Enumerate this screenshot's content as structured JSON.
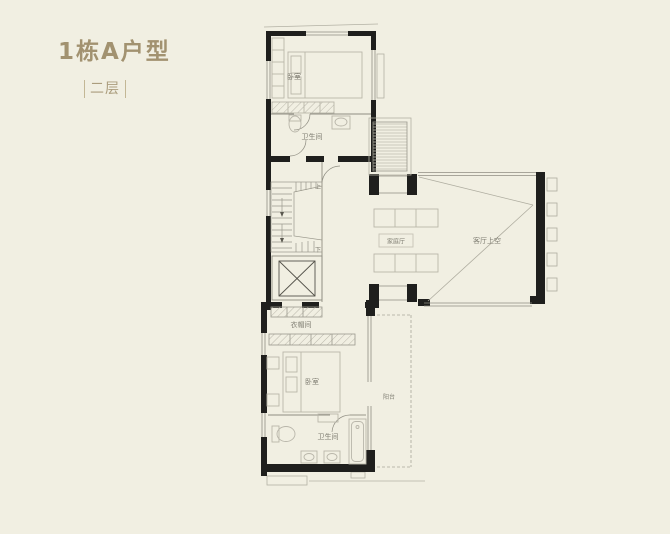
{
  "page": {
    "title": "1栋A户型",
    "subtitle": "二层",
    "colors": {
      "background": "#f1efe2",
      "accent_title": "#a29270",
      "wall": "#1f1f1d",
      "thin_line": "#8f8d82",
      "furniture_line": "#b9b6aa",
      "label_text": "#7f7d72"
    }
  },
  "floor_plan": {
    "rooms": [
      {
        "id": "bedroom-top",
        "label": "卧室"
      },
      {
        "id": "bathroom-top",
        "label": "卫生间"
      },
      {
        "id": "family-hall",
        "label": "家庭厅"
      },
      {
        "id": "living-void",
        "label": "客厅上空"
      },
      {
        "id": "closet",
        "label": "衣帽间"
      },
      {
        "id": "bedroom-bottom",
        "label": "卧室"
      },
      {
        "id": "balcony",
        "label": "阳台"
      },
      {
        "id": "bathroom-bottom",
        "label": "卫生间"
      }
    ],
    "stairs": {
      "up": "上",
      "down": "下"
    }
  }
}
